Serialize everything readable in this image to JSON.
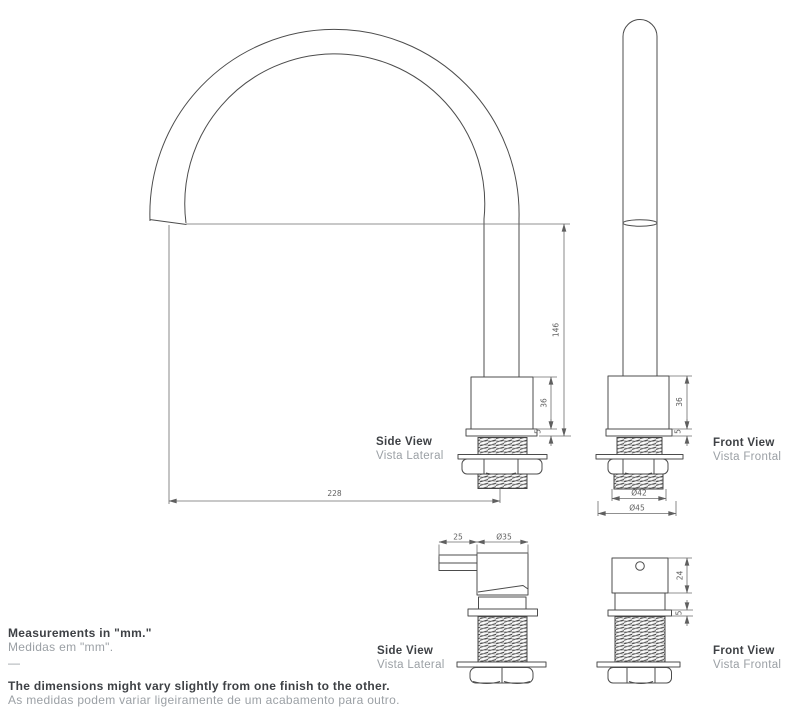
{
  "page": {
    "width": 800,
    "height": 711,
    "background": "#ffffff"
  },
  "views": {
    "top_side": {
      "en": "Side View",
      "pt": "Vista Lateral"
    },
    "top_front": {
      "en": "Front View",
      "pt": "Vista Frontal"
    },
    "bottom_side": {
      "en": "Side View",
      "pt": "Vista Lateral"
    },
    "bottom_front": {
      "en": "Front View",
      "pt": "Vista Frontal"
    }
  },
  "dimensions": {
    "spout_height": "146",
    "spout_reach": "228",
    "base_body_height_side": "36",
    "base_flange_height_side": "5",
    "base_body_height_front": "36",
    "base_flange_height_front": "5",
    "thread_diameter": "Ø42",
    "flange_diameter": "Ø45",
    "handle_lever_length": "25",
    "handle_body_diameter": "Ø35",
    "handle_body_height": "24",
    "handle_flange_height": "5"
  },
  "footer": {
    "measurements_en": "Measurements in \"mm.\"",
    "measurements_pt": "Medidas em \"mm\".",
    "separator": "—",
    "note_en": "The dimensions might vary slightly from one finish to the other.",
    "note_pt": "As medidas podem variar ligeiramente de um acabamento para outro."
  },
  "colors": {
    "line": "#4c4c4c",
    "dim_line": "#6b6b6b",
    "dim_text": "#5f5f5f",
    "label_en": "#3e4145",
    "label_pt": "#9ba0a5"
  }
}
